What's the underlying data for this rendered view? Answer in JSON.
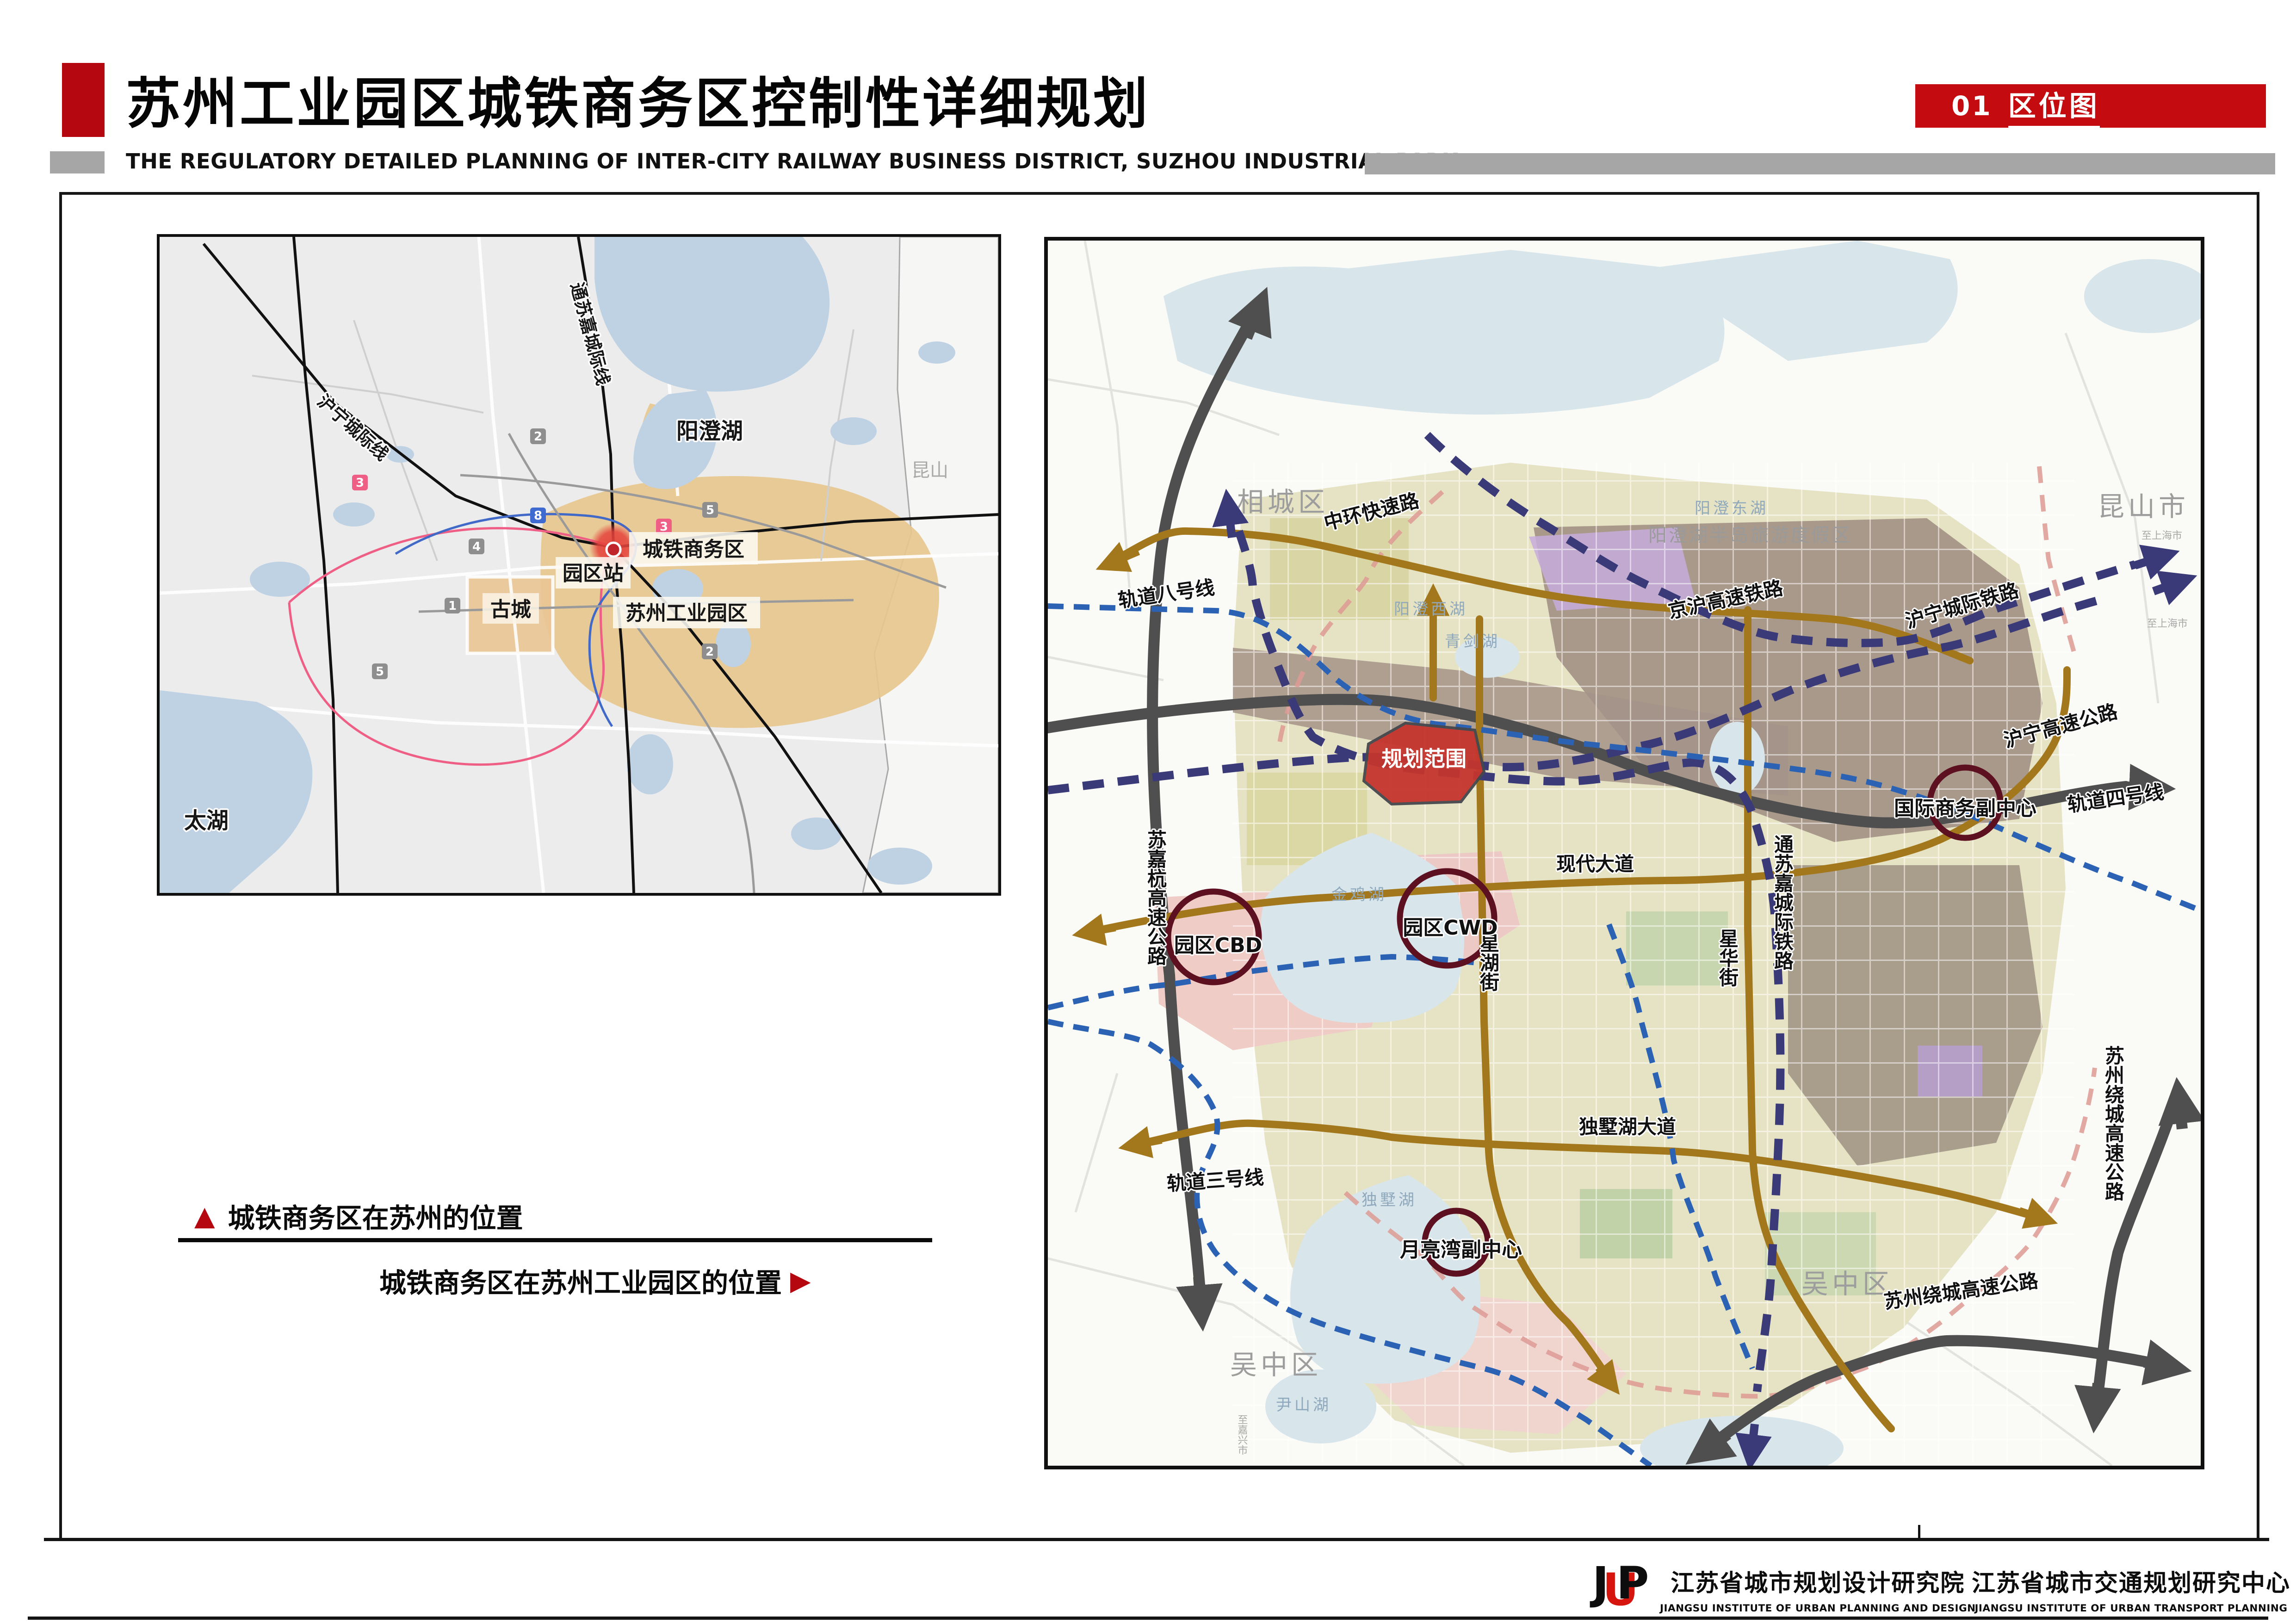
{
  "header": {
    "title": "苏州工业园区城铁商务区控制性详细规划",
    "subtitle": "THE REGULATORY DETAILED PLANNING OF INTER-CITY RAILWAY BUSINESS DISTRICT, SUZHOU INDUSTRIAL PARK",
    "badge_num": "01",
    "badge_label": "区位图"
  },
  "captions": {
    "up_triangle": "▲",
    "suzhou_position": "城铁商务区在苏州的位置",
    "sip_position": "城铁商务区在苏州工业园区的位置",
    "right_triangle": "▶"
  },
  "left_map": {
    "labels": {
      "yangcheng_lake": "阳澄湖",
      "ctbd": "城铁商务区",
      "park_station": "园区站",
      "sip": "苏州工业园区",
      "old_city": "古城",
      "tai_lake": "太湖",
      "kunshan": "昆山",
      "huning_rail": "沪宁城际线",
      "tongsujia_rail": "通苏嘉城际线"
    },
    "metro_numbers": [
      "3",
      "5",
      "2",
      "8",
      "4",
      "1",
      "3",
      "5",
      "2"
    ]
  },
  "right_map": {
    "districts": {
      "xiangcheng": "相城区",
      "kunshan": "昆山市",
      "wuzhong_w": "吴中区",
      "wuzhong_e": "吴中区"
    },
    "resort": "阳澄湖半岛旅游度假区",
    "planning_area": "规划范围",
    "centers": {
      "cbd": "园区CBD",
      "cwd": "园区CWD",
      "intl": "国际商务副中心",
      "moonbay": "月亮湾副中心"
    },
    "roads": {
      "zhonghuan": "中环快速路",
      "xiandai": "现代大道",
      "dushuhu": "独墅湖大道",
      "xinghu": "星湖街",
      "xinghua": "星华街",
      "sujiahang": "苏嘉杭高速公路",
      "huning_expwy": "沪宁高速公路",
      "raocheng_s": "苏州绕城高速公路",
      "raocheng_e": "苏州绕城高速公路"
    },
    "rails": {
      "jinghu": "京沪高速铁路",
      "huning": "沪宁城际铁路",
      "tongsujia": "通苏嘉城际铁路",
      "line8": "轨道八号线",
      "line4": "轨道四号线",
      "line3": "轨道三号线"
    },
    "lakes": {
      "jinji": "金鸡湖",
      "dushu": "独墅湖",
      "yangcheng_e": "阳澄东湖",
      "yangcheng_w": "阳澄西湖",
      "qingjian": "青剑湖",
      "yinshan": "尹山湖"
    },
    "small": {
      "to_shanghai_1": "至上海市",
      "to_shanghai_2": "至上海市",
      "to_jiaxing": "至嘉兴市"
    }
  },
  "footer": {
    "logo_j": "J",
    "logo_u": "U",
    "logo_p": "P",
    "org1_cn": "江苏省城市规划设计研究院",
    "org1_en": "JIANGSU INSTITUTE OF URBAN PLANNING AND DESIGN",
    "org2_cn": "江苏省城市交通规划研究中心",
    "org2_en": "JIANGSU INSTITUTE OF URBAN TRANSPORT PLANNING"
  },
  "colors": {
    "accent_red": "#b5070f",
    "badge_red": "#c30b10",
    "bar_gray": "#a6a6a6",
    "road_brown": "#a3781c",
    "highway_gray": "#4f4f4f",
    "rail_navy": "#3a3a78",
    "metro_blue": "#2b62b4",
    "boundary_pink": "#dd9a94",
    "center_ring": "#5c1020",
    "planning_red": "#c5352e",
    "water": "#d8e6ec",
    "sip_tan": "#e7c78e"
  }
}
